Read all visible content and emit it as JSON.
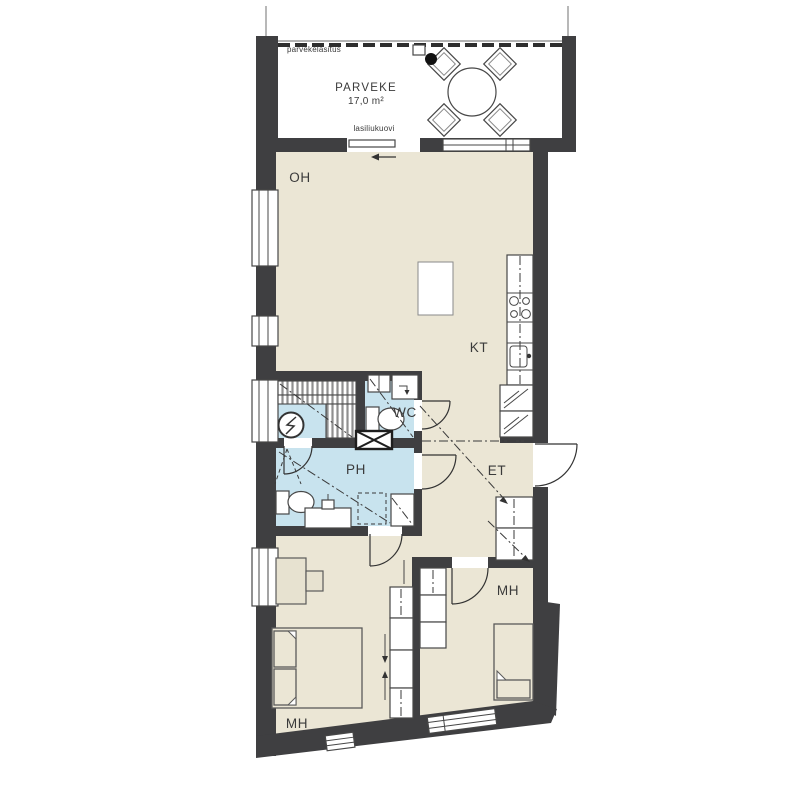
{
  "floor_plan": {
    "balcony": {
      "name": "PARVEKE",
      "area": "17,0 m²",
      "glazing_label": "parvekelasitus",
      "door_label": "lasiliukuovi"
    },
    "rooms": {
      "living_room": {
        "label": "OH"
      },
      "kitchen": {
        "label": "KT"
      },
      "wc": {
        "label": "WC"
      },
      "bathroom": {
        "label": "PH"
      },
      "hallway": {
        "label": "ET"
      },
      "bedroom_1": {
        "label": "MH"
      },
      "bedroom_2": {
        "label": "MH"
      }
    },
    "colors": {
      "wall": "#3f3f41",
      "floor": "#ebe6d5",
      "wet_floor": "#c8e3ee",
      "outline": "#474747",
      "bench_hatch": "#8f8f8f",
      "background": "#ffffff",
      "label_text": "#3a3a3a"
    },
    "fixtures": [
      "dining-table",
      "chair",
      "floor-drain",
      "balcony-glazing",
      "sliding-glass-door",
      "kitchen-island",
      "kitchen-counter",
      "stove",
      "sink",
      "tall-cabinet",
      "coat-closet",
      "wardrobe",
      "sauna-benches",
      "sauna-stove",
      "toilet",
      "washbasin",
      "washing-machine",
      "shower",
      "double-bed",
      "single-bed",
      "desk",
      "entrance-door",
      "window"
    ]
  }
}
